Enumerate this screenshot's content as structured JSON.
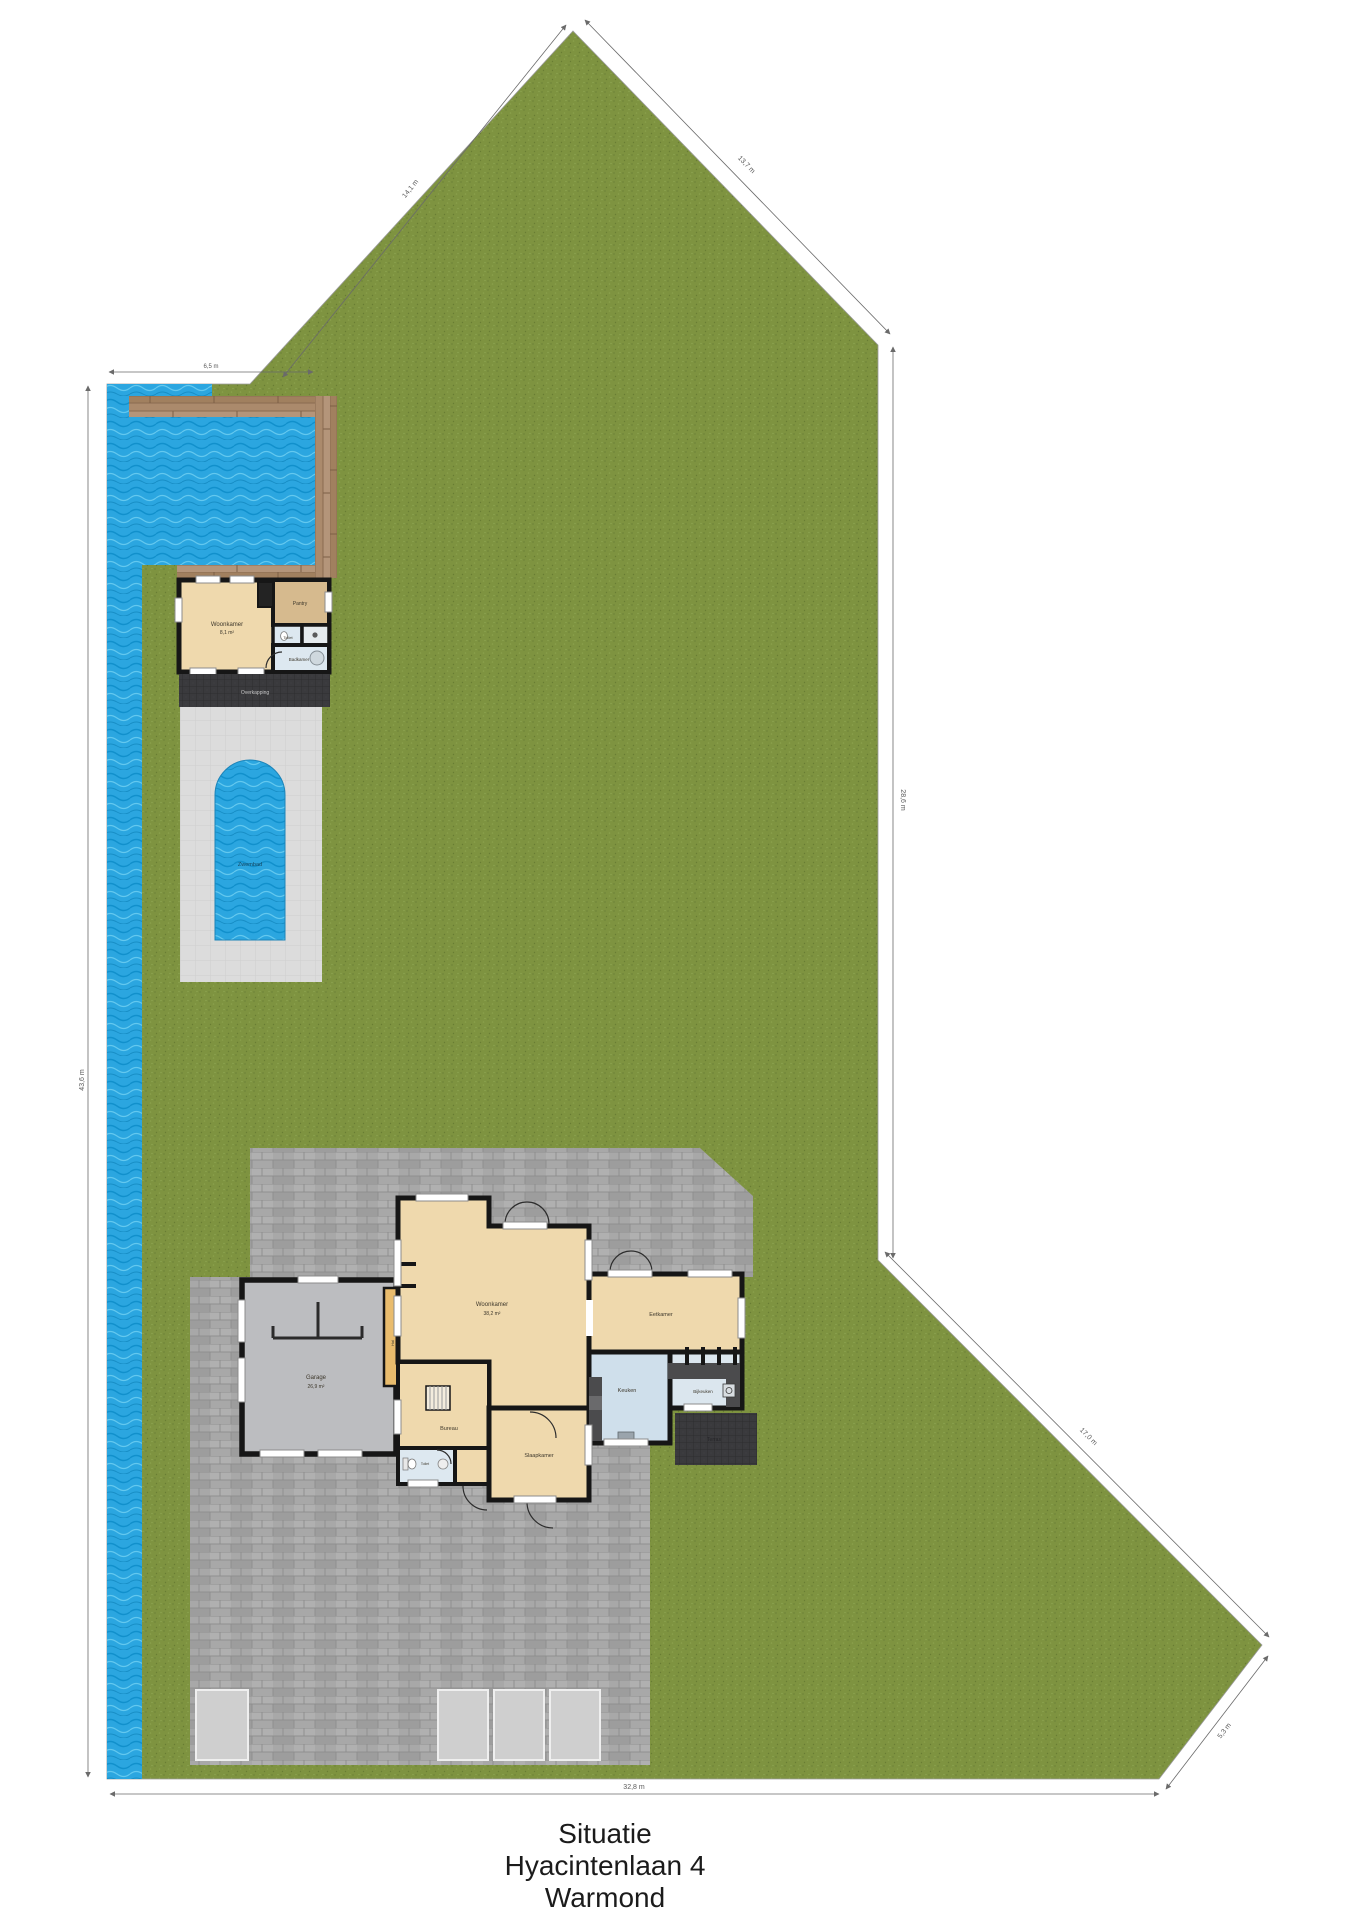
{
  "caption": {
    "line1": "Situatie",
    "line2": "Hyacintenlaan 4",
    "line3": "Warmond"
  },
  "outbuilding": {
    "living_name": "Woonkamer",
    "living_area": "8,1 m²",
    "pantry": "Pantry",
    "toilet": "Toilet",
    "bathroom": "Badkamer",
    "canopy": "Overkapping"
  },
  "pool": {
    "label": "Zwembad"
  },
  "house": {
    "living_name": "Woonkamer",
    "living_area": "38,2 m²",
    "dining": "Eetkamer",
    "kitchen": "Keuken",
    "scullery": "Bijkeuken",
    "office": "Bureau",
    "bedroom": "Slaapkamer",
    "toilet": "Toilet",
    "hall": "Hal",
    "terrace": "Terras"
  },
  "garage": {
    "name": "Garage",
    "area": "26,9 m²"
  },
  "dimensions": {
    "bottom": "32,8 m",
    "left": "43,6 m",
    "right": "28,6 m",
    "ne_diagonal": "13,7 m",
    "nw_diagonal": "14,1 m",
    "se_diagonal": "17,0 m",
    "corner": "5,3 m",
    "quay": "6,5 m"
  },
  "colors": {
    "grass": "#7e9340",
    "water": "#2ba6e0",
    "wood": "#ab8a6c",
    "paving": "#a8a8a8",
    "pool_deck": "#dcdcdc",
    "dark_roof": "#3a3a3d",
    "wall": "#161616",
    "room_beige": "#efd9ad",
    "room_tan": "#d6ba8e",
    "room_blue": "#cfdfeb",
    "room_scullery": "#dbe6ee",
    "room_bath": "#dde8f0",
    "garage_floor": "#bcbdc0",
    "hall_accent": "#e9bc6d"
  }
}
